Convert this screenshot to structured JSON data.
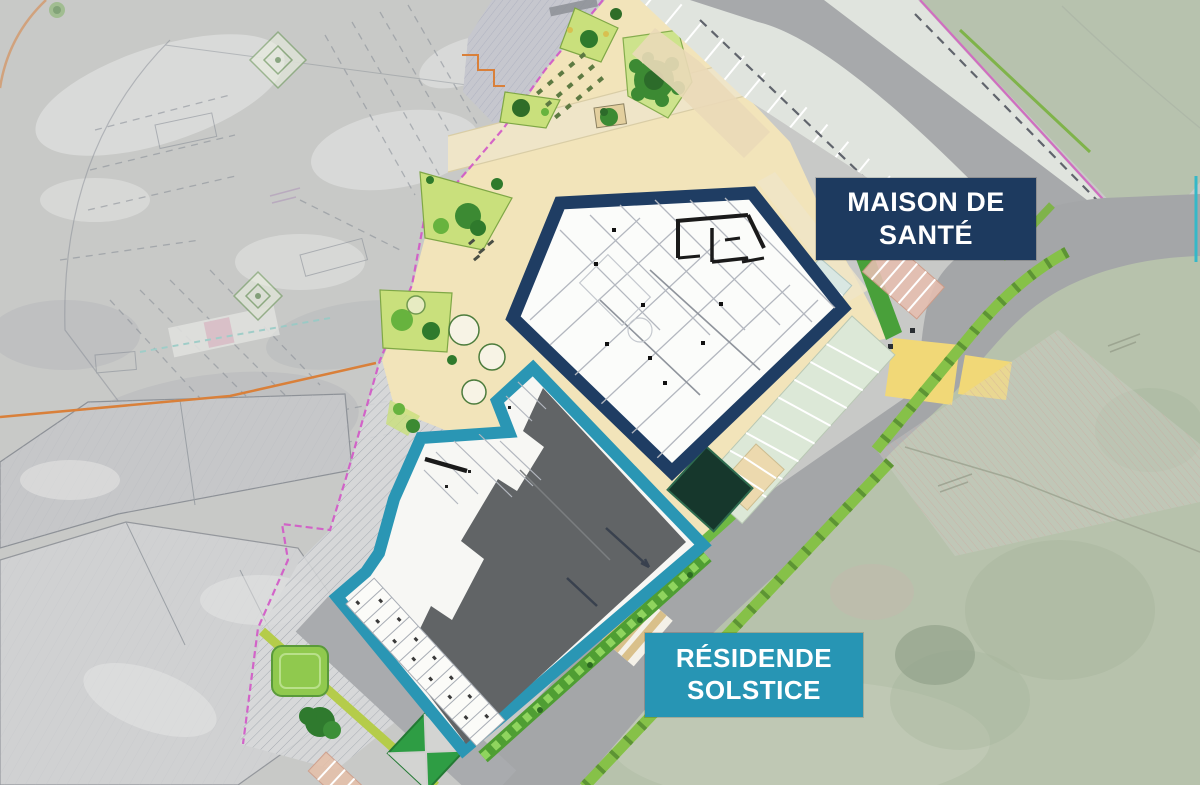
{
  "plan": {
    "labels": {
      "maison": {
        "line1": "MAISON DE",
        "line2": "SANTÉ",
        "background": "#1d3a5f",
        "text_color": "#ffffff"
      },
      "residence": {
        "line1": "RÉSIDENDE",
        "line2": "SOLSTICE",
        "background": "#2795b4",
        "text_color": "#ffffff"
      }
    },
    "palette": {
      "maison_outline": "#1f3d63",
      "residence_outline": "#2a96b4",
      "plaza_beige": "#f2e4ba",
      "road_gray": "#a4a6a8",
      "roof_dark_gray": "#616466",
      "parking_stall": "#dfe4dd",
      "aerial_gray": "#c8c9c7",
      "field_green": "#b7c2ac",
      "planting_light_green": "#c9e07c",
      "tree_dark_green": "#3c8a33",
      "verge_green": "#86c148",
      "hedge_green": "#4f9e33",
      "boundary_magenta": "#d257c6",
      "boundary_orange": "#d9803a",
      "crosswalk_tan": "#d9c08a",
      "crossing_yellow": "#f1d877",
      "floorplan_wall": "#1a1a1a"
    }
  }
}
